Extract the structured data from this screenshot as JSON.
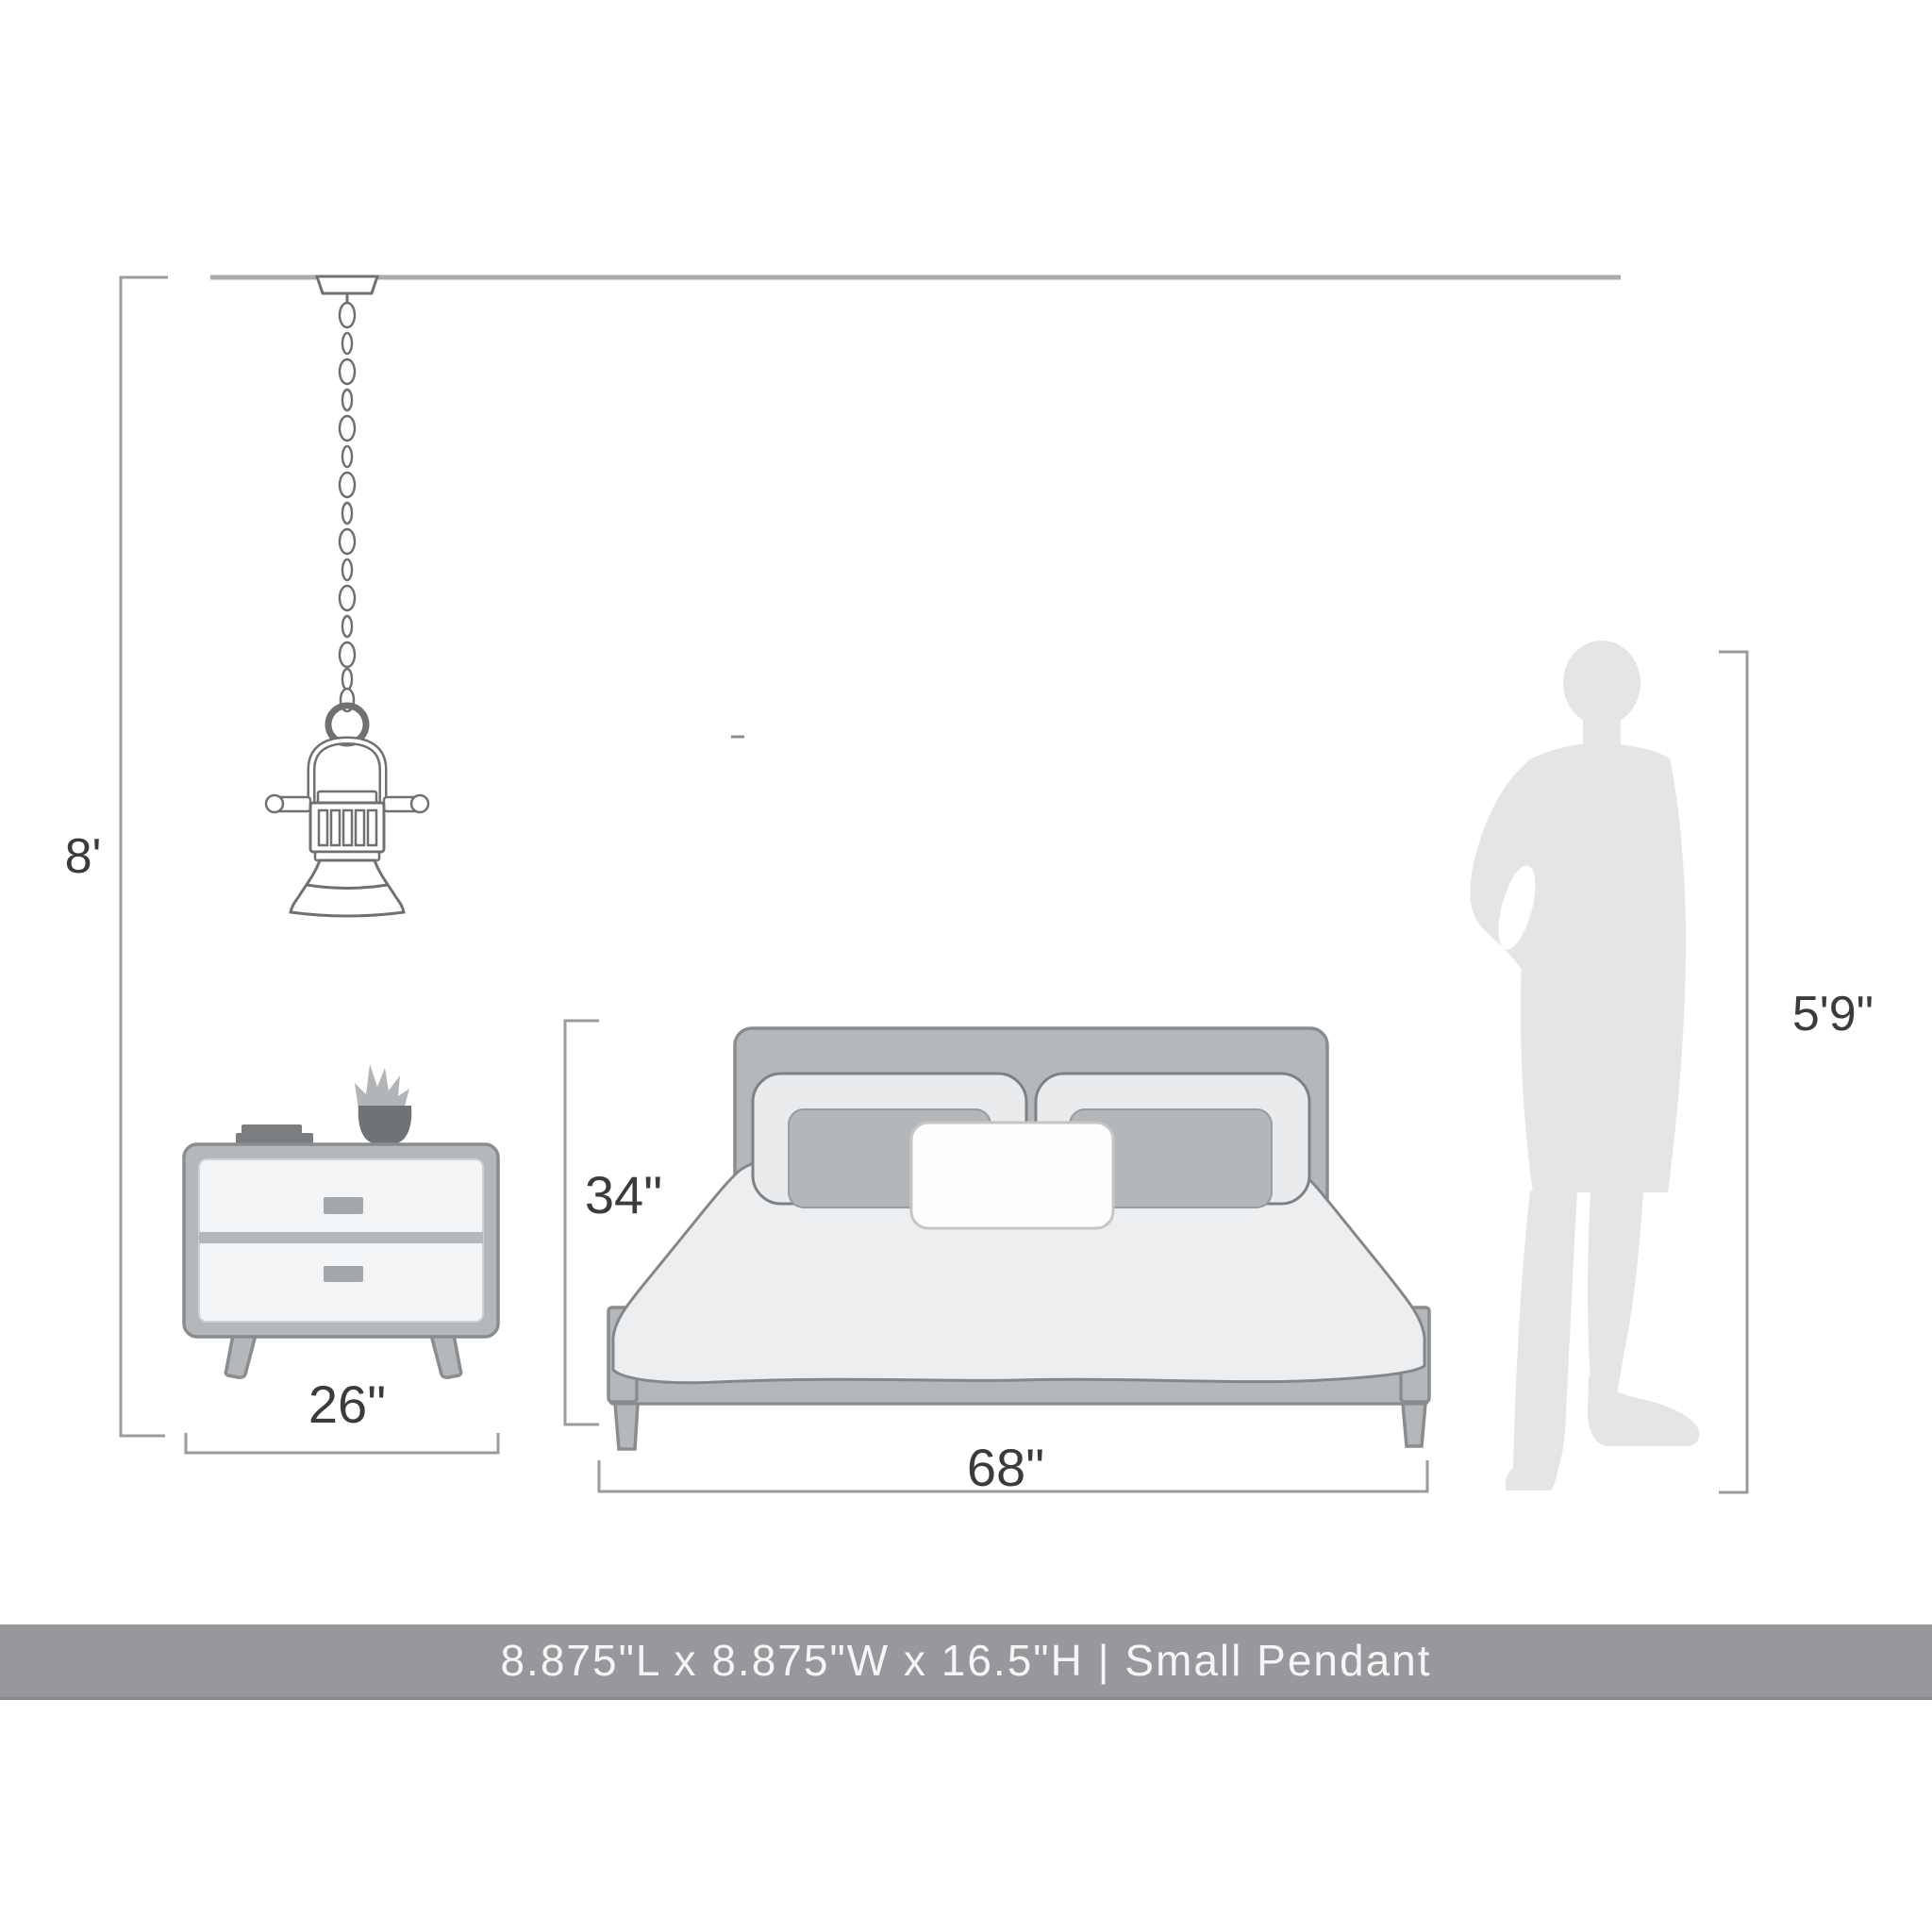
{
  "dimension_labels": {
    "ceiling_height": "8'",
    "nightstand_width": "26\"",
    "bed_height": "34\"",
    "bed_width": "68\"",
    "person_height": "5'9\""
  },
  "banner": {
    "text": "8.875\"L x 8.875\"W x 16.5\"H | Small Pendant",
    "background": "#98989c",
    "text_color": "#f5f5f6"
  },
  "objects": {
    "pendant": "small-pendant-light",
    "nightstand": "two-drawer-nightstand",
    "bed": "platform-bed-with-pillows",
    "person": "human-scale-silhouette"
  },
  "colors": {
    "dimension_line": "#9b9b9f",
    "label_text": "#3b3b3d",
    "ceiling_line": "#a9a9ad",
    "furniture_fill": "#b5b8bb",
    "furniture_stroke": "#8a8d90",
    "drawer_fill": "#f4f5f6",
    "duvet_fill": "#eceeef",
    "pillow_fill": "#e9ebec",
    "lumbar_pillow_fill": "#b4b7ba",
    "white_pillow_fill": "#fdfdfe",
    "person_fill": "#e3e5e7",
    "pendant_outline": "#6e7174"
  }
}
